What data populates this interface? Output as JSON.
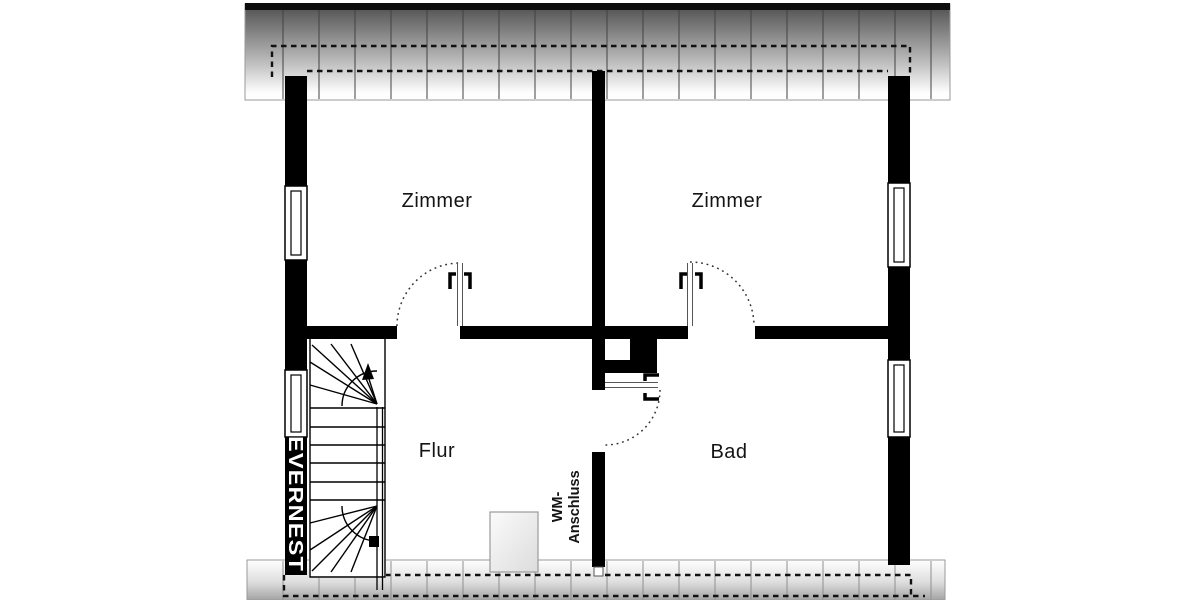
{
  "plan": {
    "rooms": [
      {
        "name": "zimmer-left",
        "label": "Zimmer"
      },
      {
        "name": "zimmer-right",
        "label": "Zimmer"
      },
      {
        "name": "flur",
        "label": "Flur"
      },
      {
        "name": "bad",
        "label": "Bad"
      }
    ],
    "annotations": {
      "wm_line1": "WM-",
      "wm_line2": "Anschluss"
    },
    "watermark": "EVERNEST",
    "colors": {
      "wall": "#000000",
      "background": "#ffffff",
      "roof_band_dark": "#4e4e4e",
      "roof_band_light": "#ffffff",
      "text": "#141414"
    }
  }
}
